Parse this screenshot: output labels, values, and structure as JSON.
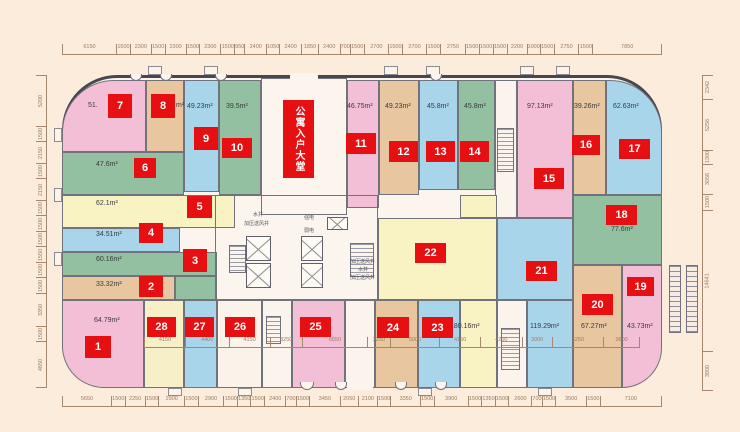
{
  "plan": {
    "lobby_label": "公寓入户大堂",
    "palette": {
      "pink": "#f3bfd6",
      "tan": "#e7c6a0",
      "green": "#92c0a0",
      "blue": "#a9d5eb",
      "yellow": "#f9f3c3",
      "cream": "#f6efc7",
      "paper": "#fbf2e9"
    },
    "accent_red": "#e60f12",
    "units": [
      {
        "no": "1",
        "area": "64.79m²",
        "color": "pink"
      },
      {
        "no": "2",
        "area": "33.32m²",
        "color": "tan"
      },
      {
        "no": "3",
        "area": "60.16m²",
        "color": "green"
      },
      {
        "no": "4",
        "area": "34.51m²",
        "color": "blue"
      },
      {
        "no": "5",
        "area": "62.1m²",
        "color": "yellow"
      },
      {
        "no": "6",
        "area": "47.6m²",
        "color": "green"
      },
      {
        "no": "7",
        "area": "51.",
        "color": "pink"
      },
      {
        "no": "8",
        "area": "m²",
        "color": "tan"
      },
      {
        "no": "9",
        "area": "49.23m²",
        "color": "blue"
      },
      {
        "no": "10",
        "area": "39.5m²",
        "color": "green"
      },
      {
        "no": "11",
        "area": "46.75m²",
        "color": "pink"
      },
      {
        "no": "12",
        "area": "49.23m²",
        "color": "tan"
      },
      {
        "no": "13",
        "area": "45.8m²",
        "color": "blue"
      },
      {
        "no": "14",
        "area": "45.8m²",
        "color": "green"
      },
      {
        "no": "15",
        "area": "97.13m²",
        "color": "pink"
      },
      {
        "no": "16",
        "area": "39.26m²",
        "color": "tan"
      },
      {
        "no": "17",
        "area": "62.63m²",
        "color": "blue"
      },
      {
        "no": "18",
        "area": "77.6m²",
        "color": "green"
      },
      {
        "no": "19",
        "area": "43.73m²",
        "color": "pink"
      },
      {
        "no": "20",
        "area": "67.27m²",
        "color": "tan"
      },
      {
        "no": "21",
        "area": "119.29m²",
        "color": "blue"
      },
      {
        "no": "22",
        "area": "180.16m²",
        "color": "yellow"
      },
      {
        "no": "23",
        "area": "",
        "color": "blue"
      },
      {
        "no": "24",
        "area": "",
        "color": "tan"
      },
      {
        "no": "25",
        "area": "",
        "color": "pink"
      },
      {
        "no": "26",
        "area": "",
        "color": "paper"
      },
      {
        "no": "27",
        "area": "",
        "color": "blue"
      },
      {
        "no": "28",
        "area": "",
        "color": "cream"
      }
    ],
    "core_labels": [
      "水井",
      "加压送风井",
      "强电",
      "弱电",
      "加压送风井",
      "水井",
      "加压送风井"
    ],
    "dims": {
      "top": [
        6150,
        1500,
        2300,
        1500,
        2300,
        1500,
        2300,
        1500,
        950,
        2400,
        1050,
        2400,
        1850,
        2400,
        700,
        1500,
        2700,
        1500,
        2700,
        1500,
        2750,
        1500,
        1500,
        1500,
        2200,
        1000,
        1500,
        2750,
        1500,
        7850
      ],
      "bottom": [
        5650,
        1500,
        2250,
        1500,
        2900,
        1500,
        2900,
        1500,
        1350,
        1500,
        2400,
        700,
        1500,
        3450,
        2050,
        2100,
        1500,
        3350,
        1500,
        3900,
        1500,
        1350,
        1500,
        2600,
        700,
        1500,
        3500,
        1500,
        7100
      ],
      "left": [
        5200,
        1500,
        2150,
        1500,
        2150,
        1500,
        1500,
        1500,
        1550,
        1500,
        1500,
        3350,
        1500,
        4650
      ],
      "right": [
        2342,
        5256,
        1300,
        3056,
        1500,
        14641,
        3900
      ],
      "inner": [
        4150,
        4400,
        4150,
        3250,
        6650,
        2250,
        5000,
        4150,
        4200,
        3000,
        5250,
        3600
      ]
    }
  }
}
